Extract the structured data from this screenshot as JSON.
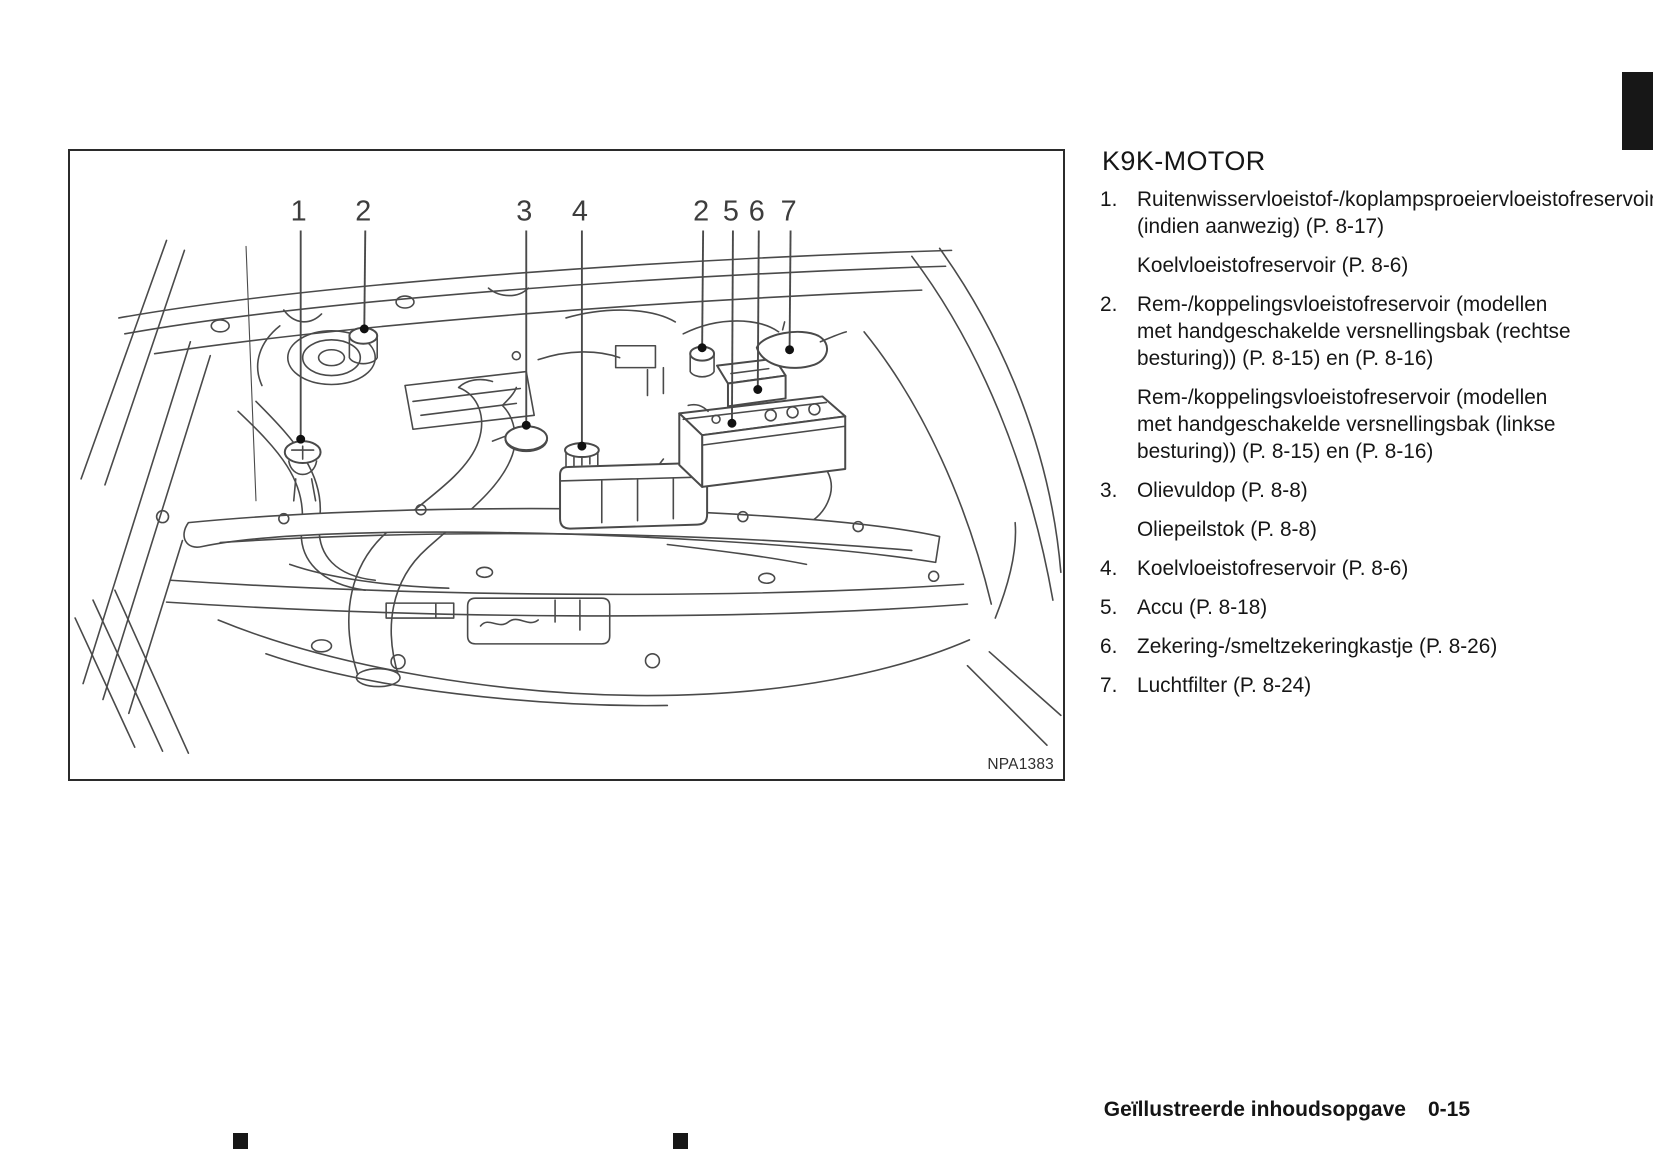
{
  "colors": {
    "ink": "#1c1c1c",
    "line_art": "#4a4a4a",
    "tab_black": "#171717"
  },
  "figure": {
    "code": "NPA1383",
    "callouts": [
      {
        "label": "1",
        "x": 229,
        "tx": 231,
        "ty": 290
      },
      {
        "label": "2",
        "x": 294,
        "tx": 295,
        "ty": 179
      },
      {
        "label": "3",
        "x": 456,
        "tx": 458,
        "ty": 276
      },
      {
        "label": "4",
        "x": 512,
        "tx": 514,
        "ty": 297
      },
      {
        "label": "2",
        "x": 634,
        "tx": 635,
        "ty": 198
      },
      {
        "label": "5",
        "x": 664,
        "tx": 665,
        "ty": 274
      },
      {
        "label": "6",
        "x": 690,
        "tx": 691,
        "ty": 240
      },
      {
        "label": "7",
        "x": 722,
        "tx": 723,
        "ty": 200
      }
    ]
  },
  "legend": {
    "title": "K9K-MOTOR",
    "items": [
      {
        "num": "1.",
        "paragraphs": [
          "Ruitenwisservloeistof-/koplampsproeiervloeistofreservoir (indien aanwezig) (P. 8-17)",
          "Koelvloeistofreservoir (P. 8-6)"
        ]
      },
      {
        "num": "2.",
        "paragraphs": [
          "Rem-/koppelingsvloeistofreservoir (modellen met handgeschakelde versnellingsbak (rechtse besturing)) (P. 8-15) en (P. 8-16)",
          "Rem-/koppelingsvloeistofreservoir (modellen met handgeschakelde versnellingsbak (linkse besturing)) (P. 8-15) en (P. 8-16)"
        ]
      },
      {
        "num": "3.",
        "paragraphs": [
          "Olievuldop (P. 8-8)",
          "Oliepeilstok (P. 8-8)"
        ]
      },
      {
        "num": "4.",
        "paragraphs": [
          "Koelvloeistofreservoir (P. 8-6)"
        ]
      },
      {
        "num": "5.",
        "paragraphs": [
          "Accu (P. 8-18)"
        ]
      },
      {
        "num": "6.",
        "paragraphs": [
          "Zekering-/smeltzekeringkastje (P. 8-26)"
        ]
      },
      {
        "num": "7.",
        "paragraphs": [
          "Luchtfilter (P. 8-24)"
        ]
      }
    ]
  },
  "footer": {
    "chapter": "Geïllustreerde inhoudsopgave",
    "page": "0-15"
  }
}
